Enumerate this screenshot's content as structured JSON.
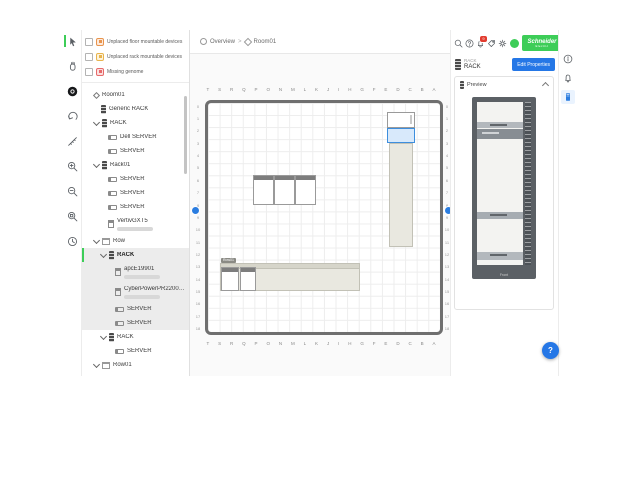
{
  "brand_color": "#3dcd58",
  "accent_blue": "#2577e6",
  "left_toolbar": {
    "tools": [
      "select",
      "pan",
      "add-device",
      "undo",
      "measure",
      "zoom-in",
      "zoom-out",
      "zoom-fit",
      "history"
    ]
  },
  "unplaced_panel": {
    "items": [
      {
        "label": "Unplaced floor mountable devices",
        "icon": "floor-device-icon",
        "fg": "#e8944d",
        "bg": "#fdeadc"
      },
      {
        "label": "Unplaced rack mountable devices",
        "icon": "rack-device-icon",
        "fg": "#e8b44d",
        "bg": "#fdf3dc"
      },
      {
        "label": "Missing genome",
        "icon": "missing-genome-icon",
        "fg": "#e66a6a",
        "bg": "#fbdfdf"
      }
    ]
  },
  "tree": {
    "items": [
      {
        "label": "Room01",
        "level": 0,
        "icon": "room",
        "chevron": false
      },
      {
        "label": "Generic RACK",
        "level": 1,
        "icon": "rack",
        "chevron": false
      },
      {
        "label": "RACK",
        "level": 1,
        "icon": "rack",
        "chevron": true
      },
      {
        "label": "Dell SERVER",
        "level": 2,
        "icon": "server",
        "chevron": false
      },
      {
        "label": "SERVER",
        "level": 2,
        "icon": "server",
        "chevron": false
      },
      {
        "label": "Rack01",
        "level": 1,
        "icon": "rack",
        "chevron": true
      },
      {
        "label": "SERVER",
        "level": 2,
        "icon": "server",
        "chevron": false
      },
      {
        "label": "SERVER",
        "level": 2,
        "icon": "server",
        "chevron": false
      },
      {
        "label": "SERVER",
        "level": 2,
        "icon": "server",
        "chevron": false
      },
      {
        "label": "VertivGXT5",
        "level": 2,
        "icon": "device",
        "chevron": false,
        "sub": true
      },
      {
        "label": "Row",
        "level": 1,
        "icon": "row",
        "chevron": true
      },
      {
        "label": "RACK",
        "level": 2,
        "icon": "rack",
        "chevron": true,
        "selected": true,
        "hl": true
      },
      {
        "label": "apcE19901",
        "level": 3,
        "icon": "device",
        "chevron": false,
        "sub": true,
        "hl": true
      },
      {
        "label": "CyberPowerPR2200R…",
        "level": 3,
        "icon": "device",
        "chevron": false,
        "sub": true,
        "hl": true
      },
      {
        "label": "SERVER",
        "level": 3,
        "icon": "server",
        "chevron": false,
        "hl": true
      },
      {
        "label": "SERVER",
        "level": 3,
        "icon": "server",
        "chevron": false,
        "hl": true
      },
      {
        "label": "RACK",
        "level": 2,
        "icon": "rack",
        "chevron": true
      },
      {
        "label": "SERVER",
        "level": 3,
        "icon": "server",
        "chevron": false
      },
      {
        "label": "Row01",
        "level": 1,
        "icon": "row",
        "chevron": true
      }
    ]
  },
  "breadcrumb": {
    "root": "Overview",
    "separator": ">",
    "current": "Room01"
  },
  "floor": {
    "col_labels": [
      "T",
      "S",
      "R",
      "Q",
      "P",
      "O",
      "N",
      "M",
      "L",
      "K",
      "J",
      "I",
      "H",
      "G",
      "F",
      "E",
      "D",
      "C",
      "B",
      "A"
    ],
    "row_labels": [
      "0",
      "1",
      "2",
      "3",
      "4",
      "5",
      "6",
      "7",
      "8",
      "9",
      "10",
      "11",
      "12",
      "13",
      "14",
      "15",
      "16",
      "17",
      "18"
    ]
  },
  "floor_objects": [
    {
      "name": "rack-top",
      "type": "rack",
      "x": 179,
      "y": 9,
      "w": 28,
      "h": 16,
      "vmark": true
    },
    {
      "name": "rack-selected",
      "type": "rack-selected",
      "x": 179,
      "y": 25,
      "w": 28,
      "h": 15
    },
    {
      "name": "row-vertical",
      "type": "row-v",
      "x": 181,
      "y": 40,
      "w": 24,
      "h": 104
    },
    {
      "name": "rack-mid-1",
      "type": "rack-h",
      "x": 45,
      "y": 72,
      "w": 21,
      "h": 30
    },
    {
      "name": "rack-mid-2",
      "type": "rack-h",
      "x": 66,
      "y": 72,
      "w": 21,
      "h": 30
    },
    {
      "name": "rack-mid-3",
      "type": "rack-h",
      "x": 87,
      "y": 72,
      "w": 21,
      "h": 30
    },
    {
      "name": "row-horizontal",
      "type": "row-h",
      "x": 12,
      "y": 160,
      "w": 140,
      "h": 28,
      "tag": "Row01"
    },
    {
      "name": "rack-bottom-1",
      "type": "rack-h",
      "x": 13,
      "y": 164,
      "w": 18,
      "h": 24
    },
    {
      "name": "rack-bottom-2",
      "type": "rack-h",
      "x": 32,
      "y": 164,
      "w": 16,
      "h": 24
    }
  ],
  "top_bar": {
    "buttons": [
      "search",
      "help",
      "notifications",
      "tag",
      "settings"
    ],
    "notification_count": "9",
    "logo_line1": "Schneider",
    "logo_line2": "Electric"
  },
  "inspector": {
    "type_label": "RACK",
    "name": "RACK",
    "edit_button": "Edit Properties"
  },
  "preview": {
    "title": "Preview",
    "front_label": "Front",
    "devices": [
      {
        "top": 20,
        "h": 6,
        "tone": "mid"
      },
      {
        "top": 27,
        "h": 10,
        "tone": "dark"
      },
      {
        "top": 110,
        "h": 7,
        "tone": "mid2"
      },
      {
        "top": 150,
        "h": 8,
        "tone": "mid"
      }
    ]
  },
  "right_rail": {
    "icons": [
      "info",
      "alarm",
      "rack"
    ]
  },
  "fab": {
    "label": "?"
  }
}
